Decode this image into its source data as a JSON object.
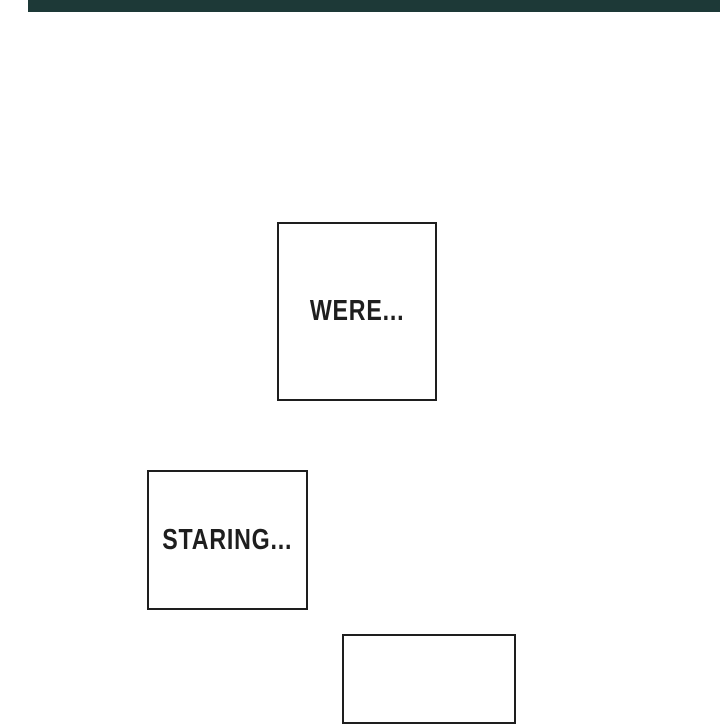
{
  "page": {
    "kind": "comic-panel-page"
  },
  "colors": {
    "page_bg": "#ffffff",
    "ink": "#1e1e1e",
    "top_strip": "#1d3937"
  },
  "panels": [
    {
      "id": "panel-were",
      "text": "WERE..."
    },
    {
      "id": "panel-staring",
      "text": "STARING..."
    },
    {
      "id": "panel-bottom",
      "text": ""
    }
  ]
}
